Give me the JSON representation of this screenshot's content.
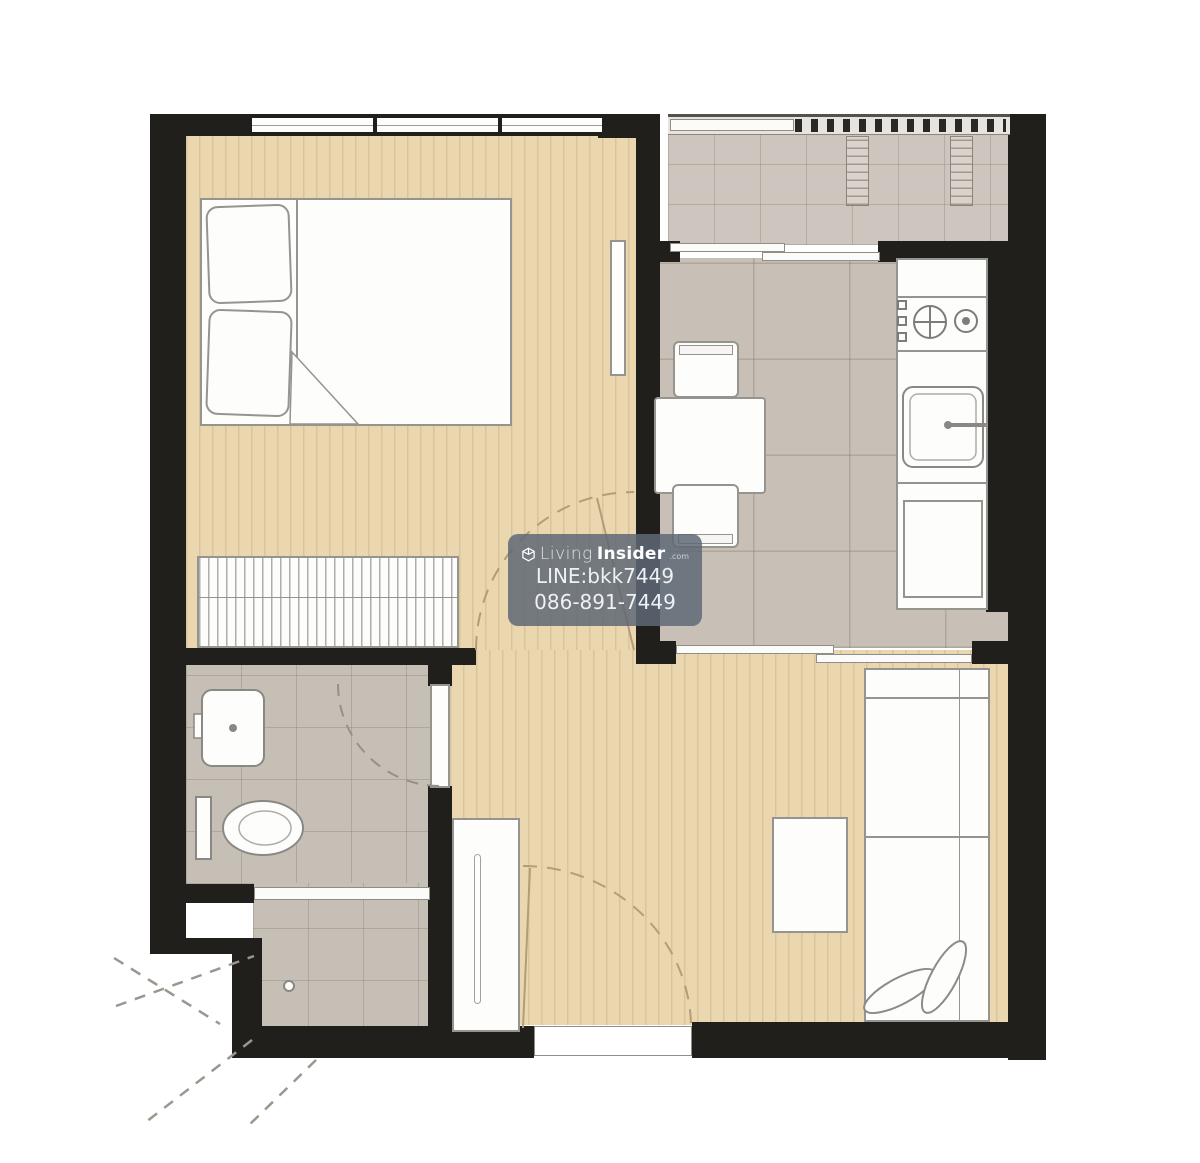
{
  "watermark": {
    "brand": {
      "icon": "cube-logo-icon",
      "light": "Living",
      "bold": "Insider",
      "tld": ".com"
    },
    "contact_line": "LINE:bkk7449",
    "phone": "086-891-7449",
    "background": "rgba(94,104,118,0.85)",
    "text_color": "#f2f5f8"
  },
  "palette": {
    "wall": "#211f1c",
    "wood_floor": "#ead7b0",
    "wood_stripe": "#c9a96e",
    "kitchen_tile": "#c8c0b6",
    "balcony_tile": "#ccc6bf",
    "bathroom_tile": "#c6bfb5",
    "fixture_fill": "#fdfdfc",
    "fixture_stroke": "#96948f",
    "door_arc_on_wood": "#b39d77",
    "door_arc_on_tile": "#97908a",
    "background": "#ffffff"
  }
}
